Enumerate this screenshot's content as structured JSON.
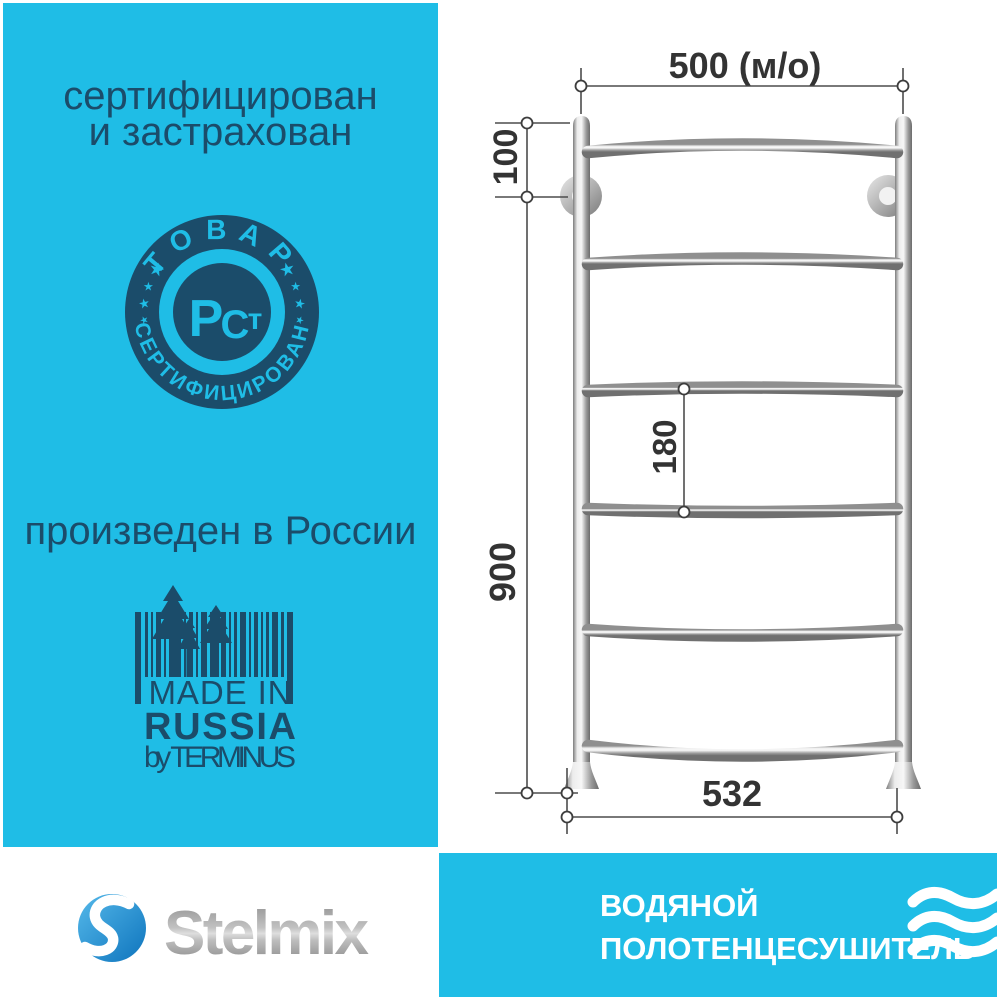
{
  "colors": {
    "cyan": "#1FBDE6",
    "navy": "#1B4C6A",
    "white": "#FFFFFF",
    "dimension_line": "#4D4D4D",
    "dimension_text": "#333333",
    "brand_blue_light": "#55B9EA",
    "brand_blue_dark": "#0E74BD",
    "metal_light": "#F2F2F2",
    "metal_dark": "#707070"
  },
  "left_panel": {
    "certified_line1": "сертифицирован",
    "certified_line2": "и застрахован",
    "stamp": {
      "top_text": "ТОВАР",
      "bottom_text": "СЕРТИФИЦИРОВАН",
      "letter_p": "Р",
      "letter_c": "С",
      "letter_t": "т"
    },
    "produced_text": "произведен в России",
    "made_in": {
      "line1": "MADE IN",
      "line2": "RUSSIA",
      "line3": "by TERMINUS"
    }
  },
  "drawing": {
    "dim_width_top": "500 (м/о)",
    "dim_offset_top": "100",
    "dim_rung_spacing": "180",
    "dim_height": "900",
    "dim_width_bottom": "532"
  },
  "footer": {
    "brand": "Stelmix",
    "product_line1": "ВОДЯНОЙ",
    "product_line2": "ПОЛОТЕНЦЕСУШИТЕЛЬ"
  }
}
